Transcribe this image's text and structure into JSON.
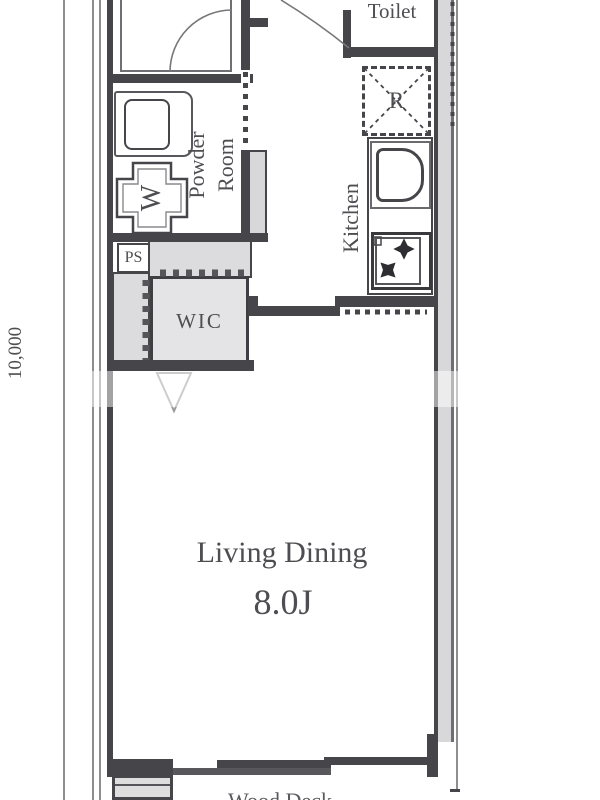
{
  "plan_title": "apartment-floor-plan",
  "dimension": {
    "left_mm": "10,000"
  },
  "rooms": {
    "toilet": {
      "label": "Toilet"
    },
    "powder_room": {
      "label_line1": "Powder",
      "label_line2": "Room"
    },
    "kitchen": {
      "label": "Kitchen"
    },
    "wic": {
      "label": "WIC"
    },
    "ps": {
      "label": "PS"
    },
    "living_dining": {
      "label": "Living Dining",
      "size": "8.0J"
    },
    "balcony": {
      "label_partial": "Wood Deck"
    }
  },
  "symbols": {
    "washing_machine": "W",
    "refrigerator": "R"
  },
  "colors": {
    "wall": "#46464a",
    "wall_fill": "#d8d8da",
    "closet_fill": "#e2e2e4",
    "text": "#4e4e52",
    "dimension_line": "#8e8e91"
  }
}
